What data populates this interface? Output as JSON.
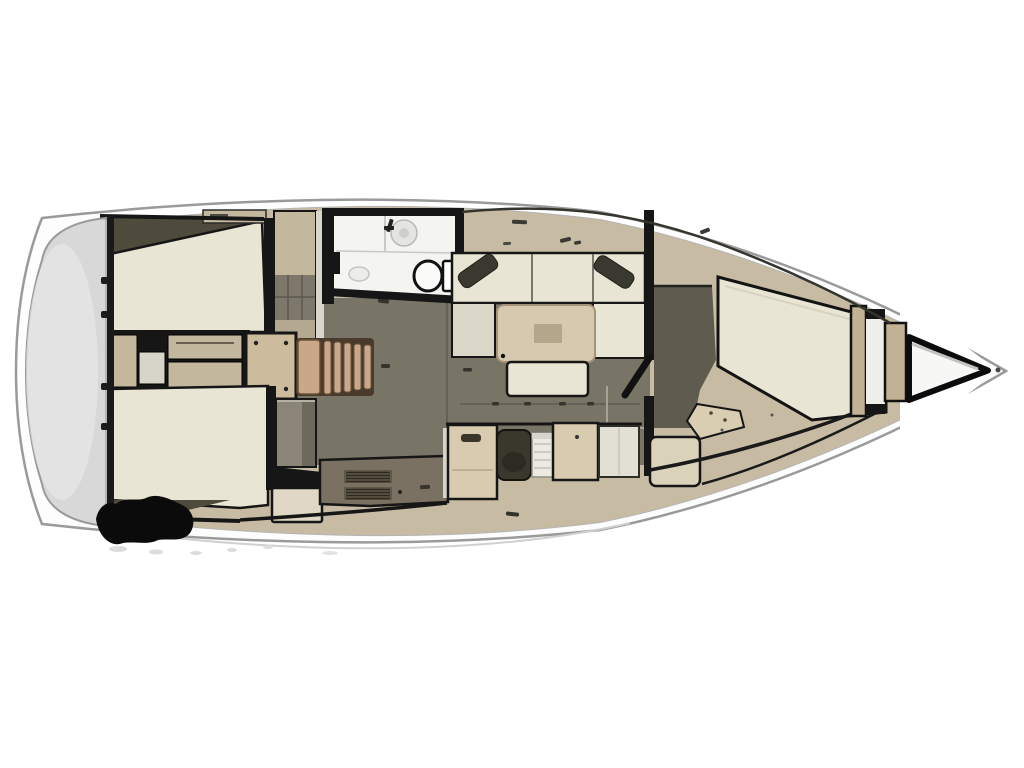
{
  "diagram": {
    "type": "sailing-yacht-interior-floor-plan",
    "view": "top-down",
    "orientation": "bow-right-stern-left",
    "visible_text": [],
    "regions": [
      {
        "id": "swim-platform",
        "desc": "rounded transom swim platform at stern (far left)"
      },
      {
        "id": "aft-cabin-port",
        "desc": "port aft double-berth cabin, top left"
      },
      {
        "id": "aft-cabin-starboard",
        "desc": "starboard aft double-berth cabin, bottom left"
      },
      {
        "id": "engine-compartment",
        "desc": "engine box with corner bolts between aft cabins"
      },
      {
        "id": "companionway-steps",
        "desc": "wooden slatted steps down into the salon"
      },
      {
        "id": "head",
        "desc": "bathroom compartment with washbasin and toilet"
      },
      {
        "id": "salon",
        "desc": "U-shaped settee with corner pillows, saloon table and bench"
      },
      {
        "id": "galley",
        "desc": "galley counter with stove vents"
      },
      {
        "id": "nav-station",
        "desc": "seat, chart table and lockers on starboard side"
      },
      {
        "id": "forward-cabin",
        "desc": "V-berth double cabin forward"
      },
      {
        "id": "anchor-locker",
        "desc": "triangular chain locker at the bow tip"
      },
      {
        "id": "watermark-blob",
        "desc": "blacked-out logo blob at lower left"
      }
    ]
  },
  "palette": {
    "page_bg": "#ffffff",
    "hull_fill": "#fdfdfd",
    "hull_stroke": "#9a9a9a",
    "inner_line": "#b4b4b4",
    "deck": "#c7bba3",
    "deck2": "#c3b79e",
    "floor": "#787466",
    "floor_seam": "#615d52",
    "wedge": "#4f4b3c",
    "berth": "#e9e5d4",
    "cushion": "#dcd8c9",
    "wall": "#161616",
    "wood": "#c9a889",
    "wood_gap": "#4a3a2b",
    "table": "#d7c9b0",
    "table_center": "#b3a68a",
    "pillow": "#3a392f",
    "galley": "#7b7163",
    "vent_bg": "#615948",
    "vent_line": "#2e2a23",
    "cabinet": "#d8cbb0",
    "seat": "#3a382d",
    "chart": "#ebe9e0",
    "panel": "#e2e0d4",
    "head_floor": "#f4f4f1",
    "gray_cabinet": "#8b8578",
    "platform": "#d8d8d8",
    "platform_hi": "#ebebeb",
    "fwd_floor": "#5f5c4f",
    "tan_bar": "#c2b295",
    "locker_white": "#f7f7f5",
    "blob": "#0b0b0b",
    "smudge": "#dcdcdc"
  }
}
